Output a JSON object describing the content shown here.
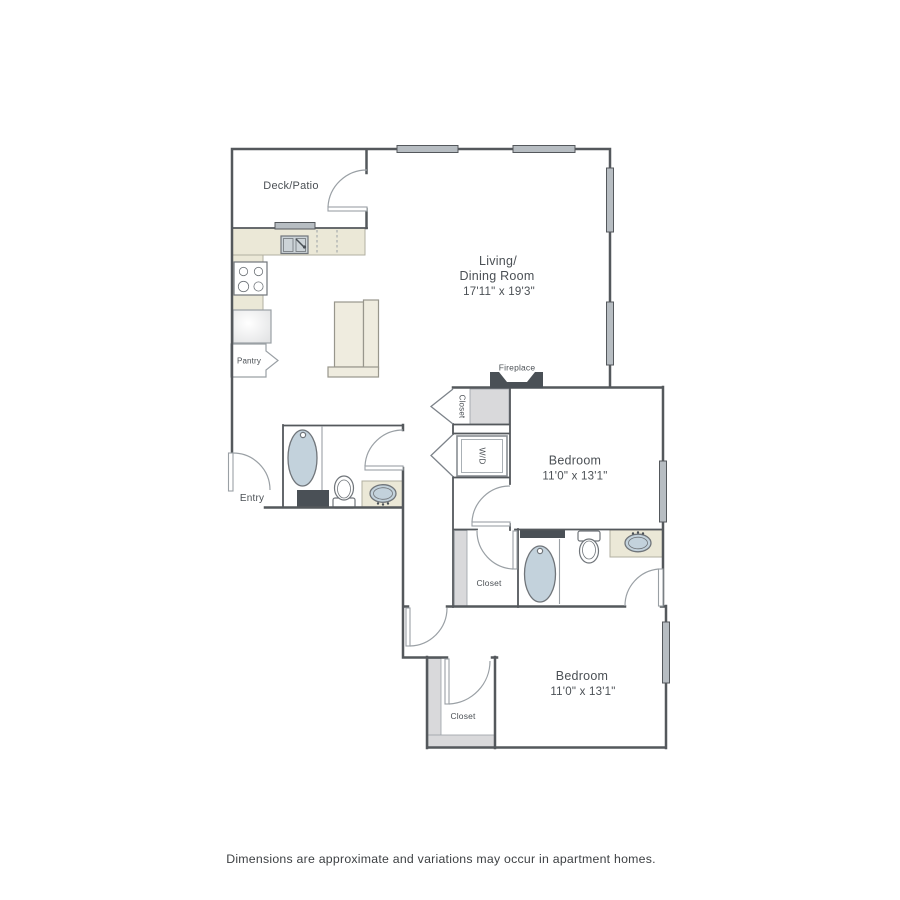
{
  "plan": {
    "rooms": {
      "deck": "Deck/Patio",
      "living_line1": "Living/",
      "living_line2": "Dining Room",
      "living_dims": "17'11\" x 19'3\"",
      "bedroom1": "Bedroom",
      "bedroom1_dims": "11'0\" x 13'1\"",
      "bedroom2": "Bedroom",
      "bedroom2_dims": "11'0\" x 13'1\""
    },
    "labels": {
      "entry": "Entry",
      "pantry": "Pantry",
      "fireplace": "Fireplace",
      "closet_hall": "Closet",
      "closet_middle": "Closet",
      "closet_bedroom2": "Closet",
      "washer_dryer": "W/D"
    },
    "colors": {
      "wall": "#54585c",
      "window": "#b7bdc2",
      "counter": "#ebe8d7",
      "counter_edge": "#b2afa0",
      "fixture": "#c3d2dc",
      "fixture_edge": "#70757a",
      "dark": "#4a5056",
      "strip": "#d9d9db",
      "line_light": "#9aa0a5",
      "sofa": "#efecdf",
      "sofa_edge": "#98968c",
      "text": "#4b5055",
      "footer": "#3d4043"
    }
  },
  "footer": {
    "disclaimer": "Dimensions are approximate and variations may occur in apartment homes."
  }
}
